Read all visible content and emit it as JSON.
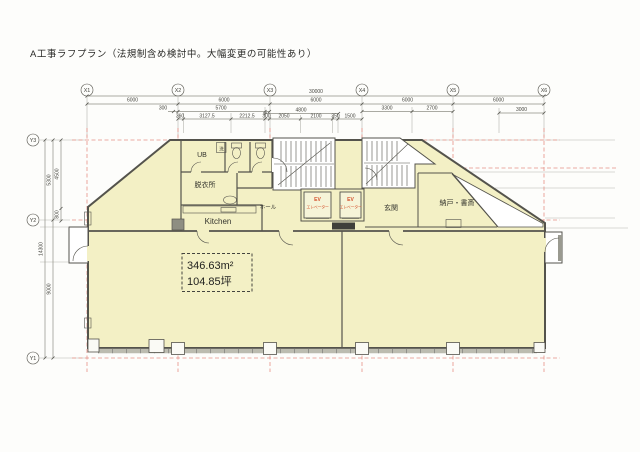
{
  "title": "A工事ラフプラン（法規制含め検討中。大幅変更の可能性あり）",
  "grid": {
    "x": [
      "X1",
      "X2",
      "X3",
      "X4",
      "X5",
      "X6"
    ],
    "y": [
      "Y3",
      "Y2",
      "Y1"
    ]
  },
  "dims": {
    "overall": "30000",
    "bays": [
      "6000",
      "6000",
      "6000",
      "6000",
      "6000"
    ],
    "row3": [
      "300",
      "5700",
      "4800",
      "3300",
      "2700",
      "3000"
    ],
    "row4": [
      "360",
      "3127.5",
      "2212.5",
      "300",
      "2050",
      "2100",
      "350",
      "1500"
    ],
    "left": {
      "total": "14300",
      "upper": "5300",
      "lower": "9000",
      "upper_sub": "4500",
      "lower_sub": "800"
    }
  },
  "rooms": {
    "ub": "UB",
    "laundry": "洗",
    "dressing_room": "脱衣所",
    "kitchen": "Kitchen",
    "hall": "ホール",
    "ev": "EV",
    "elevator": "エレベーター",
    "entrance": "玄関",
    "storage_study": "納戸・書斎"
  },
  "area": {
    "square_meters": "346.63m²",
    "tsubo": "104.85坪"
  },
  "colors": {
    "floor_fill": "#f3f0c5",
    "grid_line_dash": "#e59086",
    "ev_label_red": "#d4502a",
    "wall": "#54534c"
  }
}
